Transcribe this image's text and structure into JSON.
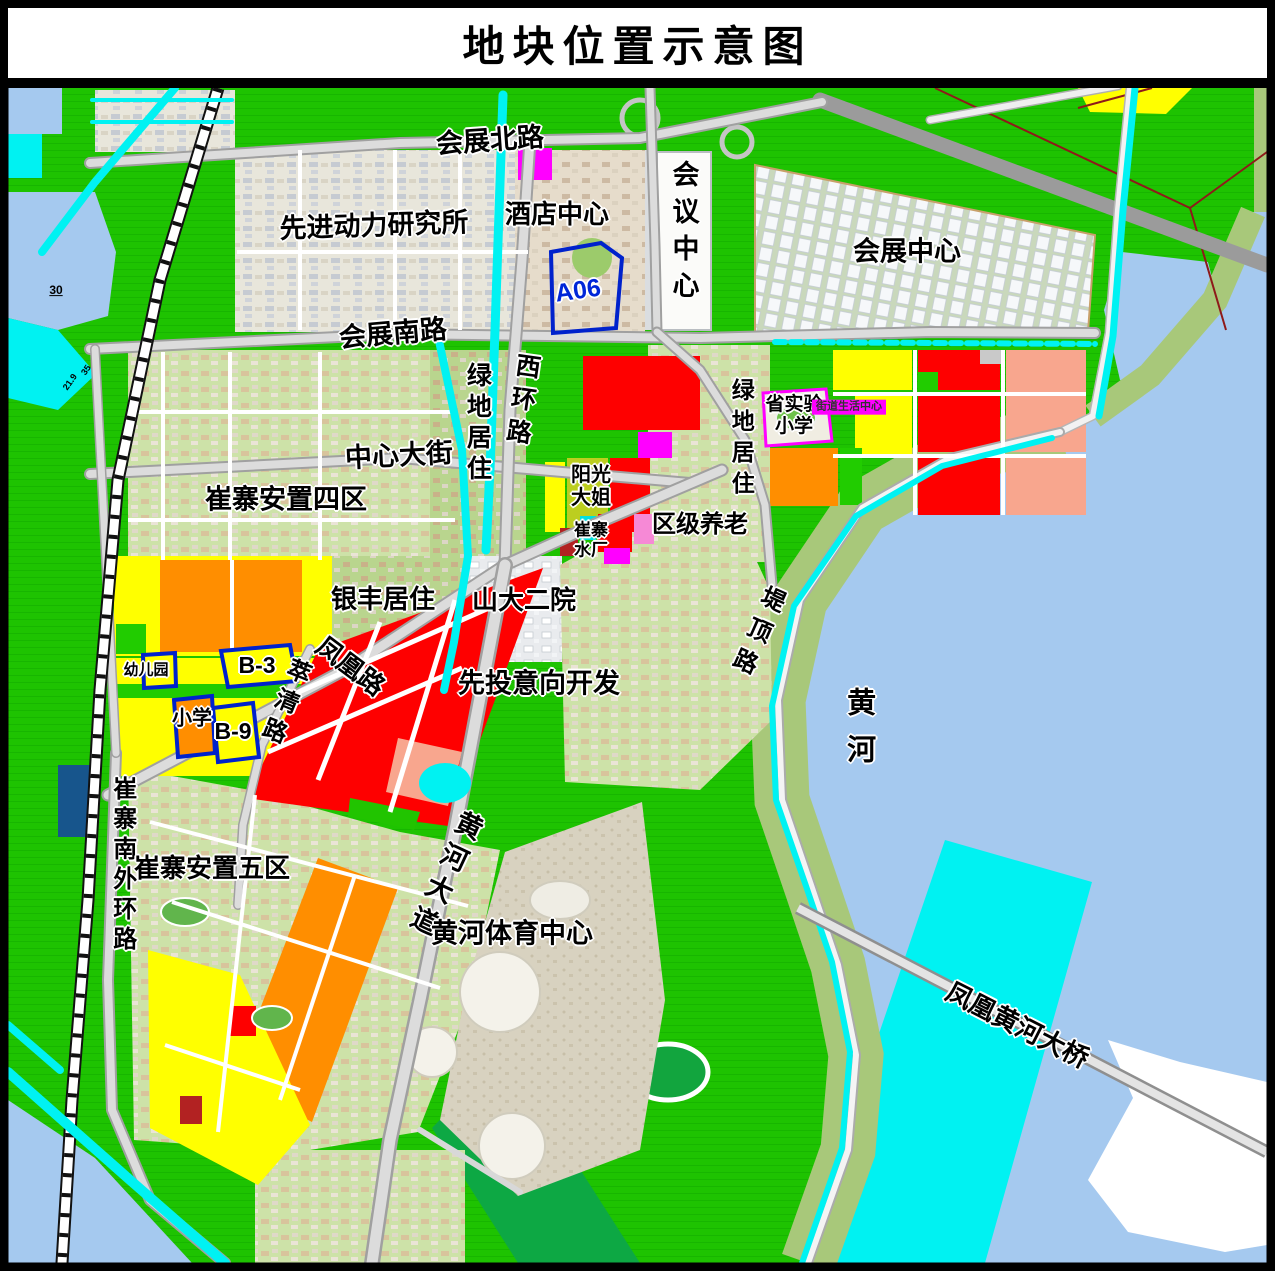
{
  "title": "地块位置示意图",
  "colors": {
    "land_green": "#1EC301",
    "water_blue": "#A5C9EF",
    "channel_cyan": "#00F2F2",
    "plot_yellow": "#FFFF00",
    "plot_orange": "#FF8E00",
    "plot_red": "#FE0000",
    "plot_magenta": "#FF00FF",
    "plot_salmon": "#F8A68E",
    "plot_olive": "#BCCE1F",
    "levee_olive": "#A8C87A",
    "road_gray": "#DCDCDC",
    "plot_outline_blue": "#0022CC",
    "navy_block": "#17558C"
  },
  "map": {
    "labels": [
      {
        "id": "road-huizhan-north-label",
        "text": "会展北路",
        "x": 490,
        "y": 141,
        "size": 27,
        "rot": -4
      },
      {
        "id": "site-adv-power-institute-label",
        "text": "先进动力研究所",
        "x": 374,
        "y": 226,
        "size": 27,
        "rot": -2
      },
      {
        "id": "site-hotel-center-label",
        "text": "酒店中心",
        "x": 557,
        "y": 215,
        "size": 26,
        "rot": 0
      },
      {
        "id": "site-conference-center-label",
        "text": "会议中心",
        "x": 683,
        "y": 234,
        "size": 27,
        "rot": 0,
        "vertical": true,
        "spacing": 10
      },
      {
        "id": "site-expo-center-label",
        "text": "会展中心",
        "x": 907,
        "y": 252,
        "size": 27,
        "rot": 0
      },
      {
        "id": "plot-a06-label",
        "text": "A06",
        "x": 578,
        "y": 291,
        "size": 25,
        "rot": -8,
        "color": "#0026D8"
      },
      {
        "id": "road-huizhan-south-label",
        "text": "会展南路",
        "x": 393,
        "y": 334,
        "size": 27,
        "rot": -5
      },
      {
        "id": "road-west-ring-label",
        "text": "西环路",
        "x": 521,
        "y": 402,
        "size": 25,
        "rot": 8,
        "vertical": true,
        "spacing": 8
      },
      {
        "id": "zone-greenland-resid-center-label",
        "text": "绿地居住",
        "x": 477,
        "y": 424,
        "size": 25,
        "rot": 0,
        "vertical": true,
        "spacing": 6
      },
      {
        "id": "road-central-avenue-label",
        "text": "中心大街",
        "x": 399,
        "y": 456,
        "size": 27,
        "rot": -3
      },
      {
        "id": "zone-cuizhai-resettle-4-label",
        "text": "崔寨安置四区",
        "x": 286,
        "y": 500,
        "size": 27,
        "rot": 0
      },
      {
        "id": "school-provincial-experimental-label",
        "text": "省实验\n小学",
        "x": 794,
        "y": 416,
        "size": 19,
        "rot": 0
      },
      {
        "id": "site-street-life-center-label",
        "text": "街道生活中心",
        "x": 849,
        "y": 407,
        "size": 11,
        "rot": 0,
        "bg": "#FF00FF",
        "halo": false,
        "color": "#333333"
      },
      {
        "id": "site-sunshine-sister-label",
        "text": "阳光\n大姐",
        "x": 591,
        "y": 487,
        "size": 20,
        "rot": 0
      },
      {
        "id": "site-cuizhai-waterworks-label",
        "text": "崔寨\n水厂",
        "x": 591,
        "y": 540,
        "size": 17,
        "rot": 0
      },
      {
        "id": "site-district-eldercare-label",
        "text": "区级养老",
        "x": 700,
        "y": 525,
        "size": 24,
        "rot": 0
      },
      {
        "id": "zone-greenland-resid-east-label",
        "text": "绿地居住",
        "x": 741,
        "y": 440,
        "size": 23,
        "rot": 0,
        "vertical": true,
        "spacing": 8
      },
      {
        "id": "road-diding-label",
        "text": "堤顶路",
        "x": 755,
        "y": 633,
        "size": 24,
        "rot": 24,
        "vertical": true,
        "spacing": 10
      },
      {
        "id": "yellow-river-label",
        "text": "黄河",
        "x": 858,
        "y": 734,
        "size": 29,
        "rot": 0,
        "vertical": true,
        "spacing": 18
      },
      {
        "id": "zone-yinfeng-resid-label",
        "text": "银丰居住",
        "x": 383,
        "y": 600,
        "size": 26,
        "rot": 0
      },
      {
        "id": "site-shanda-second-hospital-label",
        "text": "山大二院",
        "x": 524,
        "y": 601,
        "size": 26,
        "rot": 0
      },
      {
        "id": "road-fenghuang-label",
        "text": "凤凰路",
        "x": 350,
        "y": 667,
        "size": 26,
        "rot": 37
      },
      {
        "id": "plot-kindergarten-label",
        "text": "幼儿园",
        "x": 146,
        "y": 670,
        "size": 15,
        "rot": 0
      },
      {
        "id": "plot-b3-label",
        "text": "B-3",
        "x": 257,
        "y": 665,
        "size": 23,
        "rot": 0
      },
      {
        "id": "plot-primary-school-label",
        "text": "小学",
        "x": 192,
        "y": 719,
        "size": 20,
        "rot": 0
      },
      {
        "id": "plot-b9-label",
        "text": "B-9",
        "x": 233,
        "y": 731,
        "size": 23,
        "rot": 0
      },
      {
        "id": "road-cuiqing-label",
        "text": "萃清路",
        "x": 283,
        "y": 703,
        "size": 24,
        "rot": 22,
        "vertical": true,
        "spacing": 8
      },
      {
        "id": "zone-pre-investment-dev-label",
        "text": "先投意向开发",
        "x": 539,
        "y": 684,
        "size": 27,
        "rot": 0
      },
      {
        "id": "road-cuizhai-south-outer-ring-label",
        "text": "崔寨南外环路",
        "x": 122,
        "y": 866,
        "size": 24,
        "rot": 0,
        "vertical": true,
        "spacing": 6
      },
      {
        "id": "zone-cuizhai-resettle-5-label",
        "text": "崔寨安置五区",
        "x": 212,
        "y": 869,
        "size": 26,
        "rot": 0
      },
      {
        "id": "road-yellow-river-avenue-label",
        "text": "黄河大道",
        "x": 443,
        "y": 875,
        "size": 27,
        "rot": 25,
        "vertical": true,
        "spacing": 8
      },
      {
        "id": "site-yellow-river-sports-center-label",
        "text": "黄河体育中心",
        "x": 512,
        "y": 934,
        "size": 27,
        "rot": 0
      },
      {
        "id": "bridge-fenghuang-yellow-river-label",
        "text": "凤凰黄河大桥",
        "x": 1017,
        "y": 1026,
        "size": 26,
        "rot": 27
      },
      {
        "id": "note-30",
        "text": "30",
        "x": 56,
        "y": 291,
        "size": 12,
        "rot": 0,
        "underline": true,
        "halo": false
      },
      {
        "id": "note-21-9",
        "text": "21.9",
        "x": 70,
        "y": 382,
        "size": 9,
        "rot": -55,
        "halo": false
      },
      {
        "id": "note-35",
        "text": "35",
        "x": 86,
        "y": 370,
        "size": 9,
        "rot": -55,
        "halo": false
      }
    ]
  }
}
